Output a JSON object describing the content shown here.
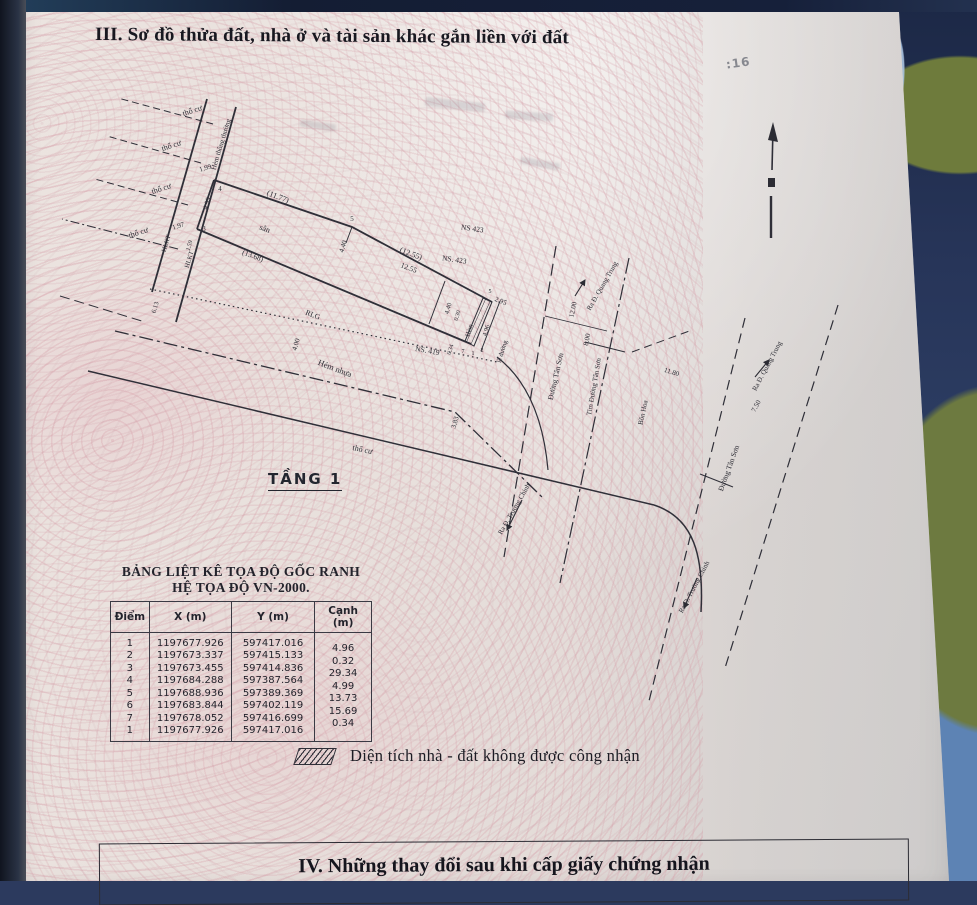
{
  "page": {
    "section_iii_title": "III. Sơ đồ thửa đất, nhà ở và tài sản khác gắn liền với đất",
    "section_iv_title": "IV. Những thay đổi sau khi cấp giấy chứng nhận",
    "floor_label": "TẦNG 1",
    "page_stamp": ":16",
    "legend_text": "Diện tích nhà - đất không được công nhận"
  },
  "coordinate_table": {
    "title_line1": "BẢNG LIỆT KÊ TỌA ĐỘ GỐC RANH",
    "title_line2": "HỆ TỌA ĐỘ VN-2000.",
    "columns": [
      "Điểm",
      "X (m)",
      "Y (m)",
      "Cạnh (m)"
    ],
    "rows": [
      {
        "diem": "1",
        "x": "1197677.926",
        "y": "597417.016",
        "canh": ""
      },
      {
        "diem": "2",
        "x": "1197673.337",
        "y": "597415.133",
        "canh": "4.96"
      },
      {
        "diem": "3",
        "x": "1197673.455",
        "y": "597414.836",
        "canh": "0.32"
      },
      {
        "diem": "4",
        "x": "1197684.288",
        "y": "597387.564",
        "canh": "29.34"
      },
      {
        "diem": "5",
        "x": "1197688.936",
        "y": "597389.369",
        "canh": "4.99"
      },
      {
        "diem": "6",
        "x": "1197683.844",
        "y": "597402.119",
        "canh": "13.73"
      },
      {
        "diem": "7",
        "x": "1197678.052",
        "y": "597416.699",
        "canh": "15.69"
      },
      {
        "diem": "1",
        "x": "1197677.926",
        "y": "597417.016",
        "canh": "0.34"
      }
    ]
  },
  "diagram": {
    "labels": [
      {
        "t": "thổ cư",
        "x": 193,
        "y": 113,
        "r": -18
      },
      {
        "t": "thổ cư",
        "x": 172,
        "y": 148,
        "r": -18
      },
      {
        "t": "thổ cư",
        "x": 162,
        "y": 191,
        "r": -18
      },
      {
        "t": "thổ cư",
        "x": 139,
        "y": 235,
        "r": -18
      },
      {
        "t": "Hẻm thông thường",
        "x": 223,
        "y": 145,
        "r": -73,
        "s": 7
      },
      {
        "t": "1.99",
        "x": 206,
        "y": 170,
        "r": -18,
        "s": 7
      },
      {
        "t": "4",
        "x": 220,
        "y": 191,
        "s": 7
      },
      {
        "t": "4.99",
        "x": 209,
        "y": 204,
        "r": -73,
        "s": 7
      },
      {
        "t": "3",
        "x": 204,
        "y": 231,
        "s": 7
      },
      {
        "t": "1.97",
        "x": 179,
        "y": 228,
        "r": -18,
        "s": 7
      },
      {
        "t": "1.59",
        "x": 191,
        "y": 246,
        "r": -73,
        "s": 6
      },
      {
        "t": "HLKT",
        "x": 168,
        "y": 244,
        "r": -73,
        "s": 6.5
      },
      {
        "t": "HLKT",
        "x": 191,
        "y": 260,
        "r": -73,
        "s": 6.5
      },
      {
        "t": "6.13",
        "x": 157,
        "y": 308,
        "r": -73,
        "s": 6.5
      },
      {
        "t": "(11.77)",
        "x": 277,
        "y": 199,
        "r": 21
      },
      {
        "t": "5",
        "x": 352,
        "y": 221,
        "s": 7
      },
      {
        "t": "(12.55)",
        "x": 410,
        "y": 256,
        "r": 21
      },
      {
        "t": "NS 423",
        "x": 472,
        "y": 231,
        "r": 8,
        "s": 7.5
      },
      {
        "t": "NS. 423",
        "x": 454,
        "y": 262,
        "r": 8,
        "s": 7.5
      },
      {
        "t": "sân",
        "x": 264,
        "y": 231,
        "r": 21
      },
      {
        "t": "(13.68)",
        "x": 252,
        "y": 258,
        "r": 21,
        "s": 7.5
      },
      {
        "t": "4.40",
        "x": 345,
        "y": 247,
        "r": -73,
        "s": 7
      },
      {
        "t": "12.55",
        "x": 408,
        "y": 270,
        "r": 21,
        "s": 7.5
      },
      {
        "t": "NS. 419",
        "x": 427,
        "y": 353,
        "r": 10,
        "s": 7.5
      },
      {
        "t": "4.40",
        "x": 450,
        "y": 309,
        "r": -73,
        "s": 6.5
      },
      {
        "t": "0.30",
        "x": 459,
        "y": 316,
        "r": -73,
        "s": 6
      },
      {
        "t": "Hẻm",
        "x": 471,
        "y": 331,
        "r": -73,
        "s": 6.5
      },
      {
        "t": "4.96",
        "x": 488,
        "y": 331,
        "r": -73,
        "s": 6.5
      },
      {
        "t": "2.95",
        "x": 500,
        "y": 303,
        "r": 21,
        "s": 7
      },
      {
        "t": "5",
        "x": 490,
        "y": 293,
        "s": 6
      },
      {
        "t": "lề đường",
        "x": 504,
        "y": 352,
        "r": -73,
        "s": 6.5
      },
      {
        "t": "0.34",
        "x": 452,
        "y": 350,
        "r": -73,
        "s": 6
      },
      {
        "t": "7",
        "x": 463,
        "y": 353,
        "s": 6
      },
      {
        "t": "1",
        "x": 473,
        "y": 355,
        "s": 6
      },
      {
        "t": "2",
        "x": 482,
        "y": 352,
        "s": 6
      },
      {
        "t": "RLG",
        "x": 312,
        "y": 317,
        "r": 21,
        "s": 7.5
      },
      {
        "t": "4.00",
        "x": 298,
        "y": 345,
        "r": -73,
        "s": 7
      },
      {
        "t": "Hẻm nhựa",
        "x": 334,
        "y": 371,
        "r": 21,
        "s": 8.5
      },
      {
        "t": "3.83",
        "x": 457,
        "y": 423,
        "r": -73,
        "s": 7
      },
      {
        "t": "thổ cư",
        "x": 362,
        "y": 452,
        "r": 12
      },
      {
        "t": "Đường Tân Sơn",
        "x": 558,
        "y": 377,
        "r": -77,
        "s": 7.5
      },
      {
        "t": "12.00",
        "x": 575,
        "y": 310,
        "r": -78,
        "s": 7
      },
      {
        "t": "8.00",
        "x": 589,
        "y": 340,
        "r": -78,
        "s": 7
      },
      {
        "t": "Ra Đ. Quang Trung",
        "x": 604,
        "y": 287,
        "r": -60,
        "s": 7
      },
      {
        "t": "Tim Đường Tân Sơn",
        "x": 596,
        "y": 387,
        "r": -80,
        "s": 7
      },
      {
        "t": "Bồn Hoa",
        "x": 645,
        "y": 413,
        "r": -78,
        "s": 7
      },
      {
        "t": "11.80",
        "x": 671,
        "y": 374,
        "r": 18,
        "s": 7
      },
      {
        "t": "Đường Tân Sơn",
        "x": 731,
        "y": 469,
        "r": -70,
        "s": 7.5
      },
      {
        "t": "Ra Đ. Quang Trung",
        "x": 769,
        "y": 367,
        "r": -62,
        "s": 7
      },
      {
        "t": "7.50",
        "x": 758,
        "y": 407,
        "r": -62,
        "s": 7
      },
      {
        "t": "Ra Đ. Trường Chinh",
        "x": 516,
        "y": 510,
        "r": -60,
        "s": 7
      },
      {
        "t": "Ra Đ. Trường Chinh",
        "x": 696,
        "y": 588,
        "r": -62,
        "s": 7
      }
    ]
  }
}
